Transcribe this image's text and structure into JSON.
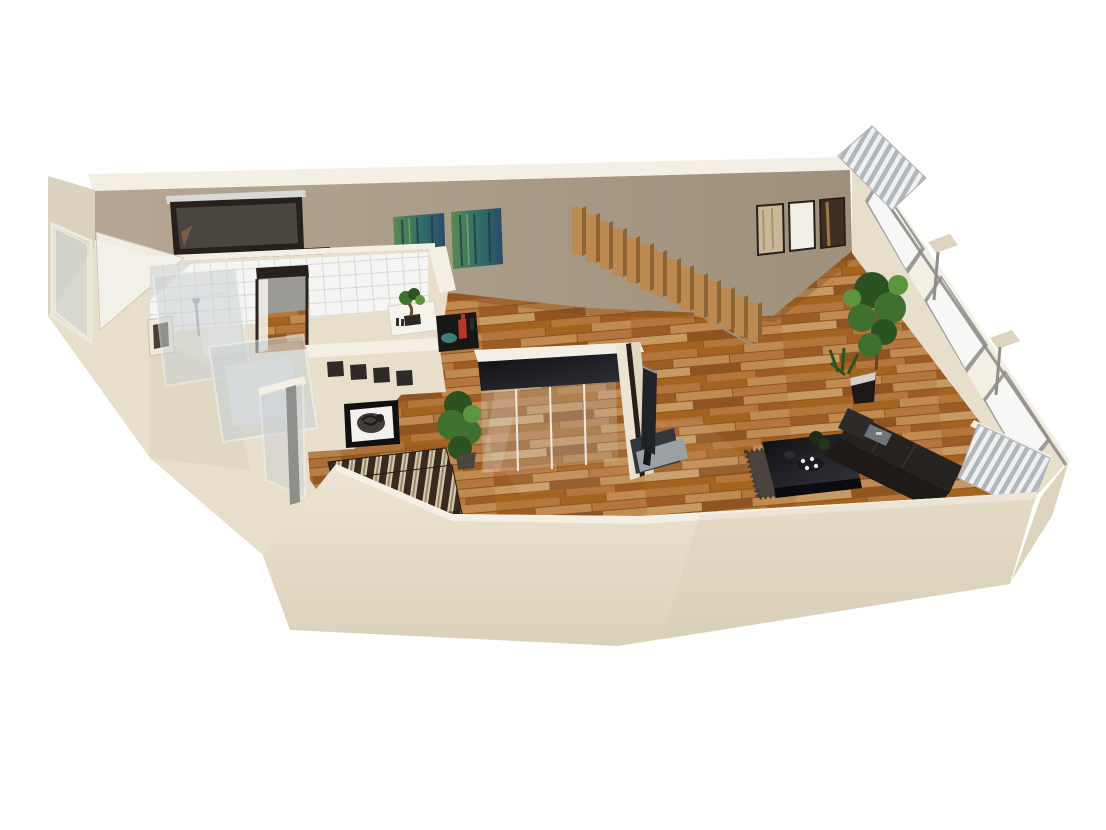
{
  "scene": {
    "description": "3D rendered bird's-eye floor plan of a studio apartment with bathroom, floating staircase, mirrored wardrobe, sofa area, striped daybed nook, panoramic windows and parquet floor",
    "background": "#ffffff",
    "objects": [
      "tiled bathroom with glass shower and bathtub",
      "vanity mirror with chrome rail",
      "hallway door",
      "floating wood staircase",
      "green abstract diptych painting",
      "three framed wall panels",
      "mirrored sliding wardrobe",
      "flat-screen tv on low stand",
      "black coffee table with dark rug",
      "dark fabric sofa",
      "brown striped daybed",
      "black and white framed artwork",
      "glass partition",
      "indoor plants",
      "panoramic window wall",
      "striped exterior awnings",
      "parquet wood floor"
    ]
  },
  "colors": {
    "background": "#ffffff",
    "wallRim": "#f4efe4",
    "wallLight": "#e7dfcc",
    "wallMid": "#ddd3bf",
    "wallDark": "#c7bca6",
    "wallShade": "#d3c9b4",
    "faceTanA": "#b5a793",
    "faceTanB": "#9f907c",
    "frontA": "#ede5d3",
    "frontB": "#dbd1bb",
    "woodGap": "#8a5526",
    "wood1": "#b5763c",
    "wood2": "#a4631f",
    "wood3": "#c08a50",
    "wood4": "#9d5c24",
    "wood5": "#c79a62",
    "wood6": "#8f5420",
    "floorShadow": "#7a4a1e",
    "tileWhite": "#f5f5f3",
    "tileLine": "#d9d8d3",
    "glass": "#ccd1d4",
    "glassWhite": "#f7f8f6",
    "frameDark": "#26211c",
    "stairWood": "#bc8a50",
    "stairWoodDark": "#8f6433",
    "railGray": "#97928a",
    "artGreen": "#5a8b50",
    "artTeal": "#2f6d68",
    "artBlue": "#2b4a68",
    "panelBeige": "#c9b795",
    "panelWhite": "#f1eee6",
    "panelDark": "#3f2e22",
    "mirrorGlass": "#4b453f",
    "chrome": "#d9d8d4",
    "counterDark": "#15130f",
    "blackA": "#0e0e12",
    "blackB": "#34343c",
    "sofaBack": "#262220",
    "sofaSeat": "#1d1a18",
    "rugGray": "#45423e",
    "stripeDark": "#3a291d",
    "stripeCream": "#d5c9ad",
    "stripeGray": "#968871",
    "plantGreen": "#3f7030",
    "plantDark": "#2c5222",
    "plantLight": "#5d9440",
    "potBlack": "#1b1918",
    "vaseRed": "#b33a28",
    "bowlTeal": "#3f7d7a",
    "awnLight": "#eef0f1",
    "awnGray": "#b2b7bb",
    "metalGray": "#8e8e8b",
    "tvScreen": "#1f2226",
    "tvEdge": "#8e959b",
    "tvBase": "#9aa0a4",
    "standGray": "#33373b",
    "mirrorTint": "#cfdbe2"
  }
}
